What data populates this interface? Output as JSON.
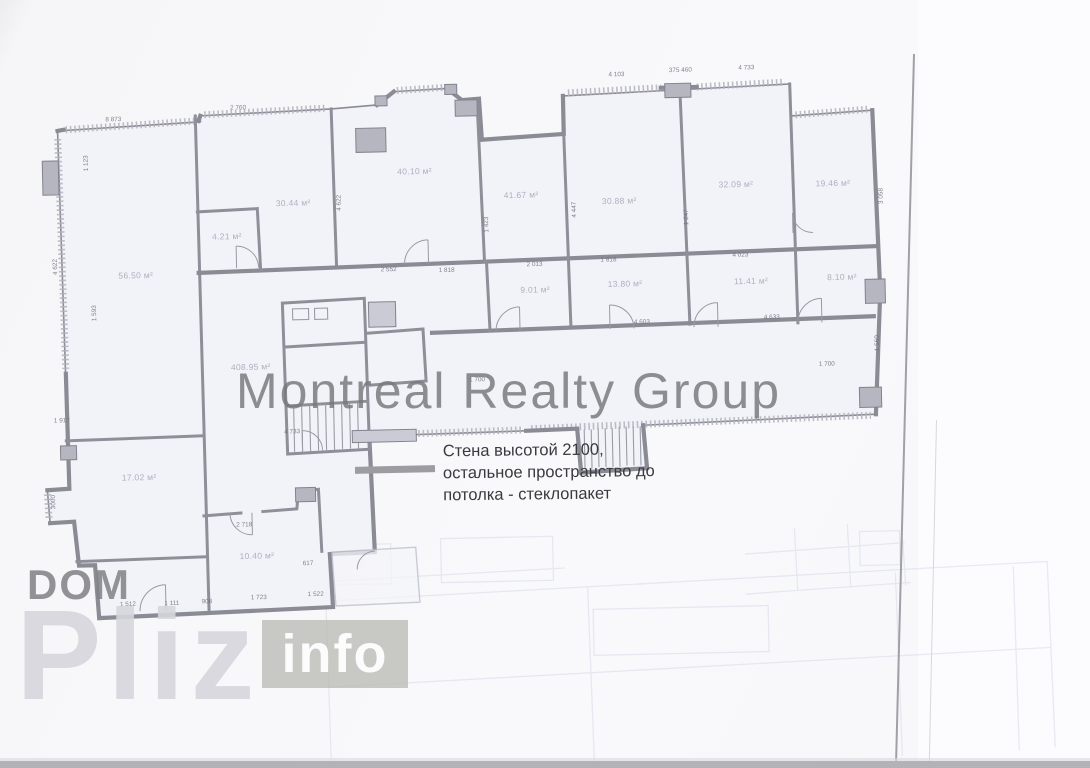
{
  "page": {
    "background": "#f9f9fb",
    "bottom_strip_color": "#b2b2b7",
    "scan_edge_color": "#a0a0a5"
  },
  "watermarks": {
    "center": "Montreal Realty Group",
    "dom": "DOM",
    "pliz": "Pliz",
    "info": "info"
  },
  "annotation": {
    "lines": [
      "Стена высотой 2100,",
      "остальное пространство до",
      "потолка - стеклопакет"
    ],
    "legend_color": "#9c9ca1"
  },
  "plan": {
    "wall_color": "#8b8b96",
    "room_fill": "#f2f3f8",
    "rooms": [
      {
        "t": "56.50 м²",
        "x": 137,
        "y": 268
      },
      {
        "t": "30.44 м²",
        "x": 296,
        "y": 199
      },
      {
        "t": "4.21 м²",
        "x": 229,
        "y": 231
      },
      {
        "t": "40.10 м²",
        "x": 418,
        "y": 170
      },
      {
        "t": "41.67 м²",
        "x": 524,
        "y": 196
      },
      {
        "t": "30.88 м²",
        "x": 622,
        "y": 204
      },
      {
        "t": "32.09 м²",
        "x": 739,
        "y": 190
      },
      {
        "t": "19.46 м²",
        "x": 836,
        "y": 191
      },
      {
        "t": "9.01 м²",
        "x": 536,
        "y": 291
      },
      {
        "t": "13.80 м²",
        "x": 626,
        "y": 287
      },
      {
        "t": "11.41 м²",
        "x": 752,
        "y": 287
      },
      {
        "t": "8.10 м²",
        "x": 843,
        "y": 285
      },
      {
        "t": "408.95 м²",
        "x": 250,
        "y": 362
      },
      {
        "t": "17.02 м²",
        "x": 136,
        "y": 470
      },
      {
        "t": "10.40 м²",
        "x": 252,
        "y": 551
      }
    ],
    "dimensions": [
      {
        "t": "8 873",
        "x": 118,
        "y": 112,
        "r": 0
      },
      {
        "t": "2 760",
        "x": 243,
        "y": 103,
        "r": 0
      },
      {
        "t": "4 103",
        "x": 622,
        "y": 78,
        "r": 0
      },
      {
        "t": "375 460",
        "x": 686,
        "y": 75,
        "r": 0
      },
      {
        "t": "4 733",
        "x": 752,
        "y": 74,
        "r": 0
      },
      {
        "t": "1 123",
        "x": 90,
        "y": 155,
        "r": 90
      },
      {
        "t": "4 622",
        "x": 57,
        "y": 258,
        "r": 90
      },
      {
        "t": "1 593",
        "x": 95,
        "y": 305,
        "r": 90
      },
      {
        "t": "1 917",
        "x": 60,
        "y": 412,
        "r": 0
      },
      {
        "t": "4 733",
        "x": 290,
        "y": 428,
        "r": 0
      },
      {
        "t": "2 552",
        "x": 390,
        "y": 268,
        "r": 0
      },
      {
        "t": "1 818",
        "x": 448,
        "y": 270,
        "r": 0
      },
      {
        "t": "1 700",
        "x": 476,
        "y": 380,
        "r": 0
      },
      {
        "t": "1 700",
        "x": 826,
        "y": 372,
        "r": 0
      },
      {
        "t": "4 622",
        "x": 342,
        "y": 200,
        "r": 90
      },
      {
        "t": "1 423",
        "x": 489,
        "y": 225,
        "r": 90
      },
      {
        "t": "4 447",
        "x": 577,
        "y": 212,
        "r": 90
      },
      {
        "t": "1 247",
        "x": 689,
        "y": 222,
        "r": 90
      },
      {
        "t": "3 058",
        "x": 884,
        "y": 205,
        "r": 90
      },
      {
        "t": "1 560",
        "x": 877,
        "y": 352,
        "r": 90
      },
      {
        "t": "2 013",
        "x": 536,
        "y": 266,
        "r": 0
      },
      {
        "t": "1 818",
        "x": 610,
        "y": 263,
        "r": 0
      },
      {
        "t": "4 023",
        "x": 742,
        "y": 261,
        "r": 0
      },
      {
        "t": "4 603",
        "x": 642,
        "y": 326,
        "r": 0
      },
      {
        "t": "4 633",
        "x": 772,
        "y": 324,
        "r": 0
      },
      {
        "t": "2 718",
        "x": 240,
        "y": 520,
        "r": 0
      },
      {
        "t": "3000",
        "x": 50,
        "y": 493,
        "r": 90
      },
      {
        "t": "617",
        "x": 303,
        "y": 560,
        "r": 0
      },
      {
        "t": "1 512",
        "x": 122,
        "y": 597,
        "r": 0
      },
      {
        "t": "1 111",
        "x": 166,
        "y": 597,
        "r": 0
      },
      {
        "t": "908",
        "x": 201,
        "y": 596,
        "r": 0
      },
      {
        "t": "1 723",
        "x": 253,
        "y": 593,
        "r": 0
      },
      {
        "t": "1 522",
        "x": 310,
        "y": 591,
        "r": 0
      }
    ]
  }
}
